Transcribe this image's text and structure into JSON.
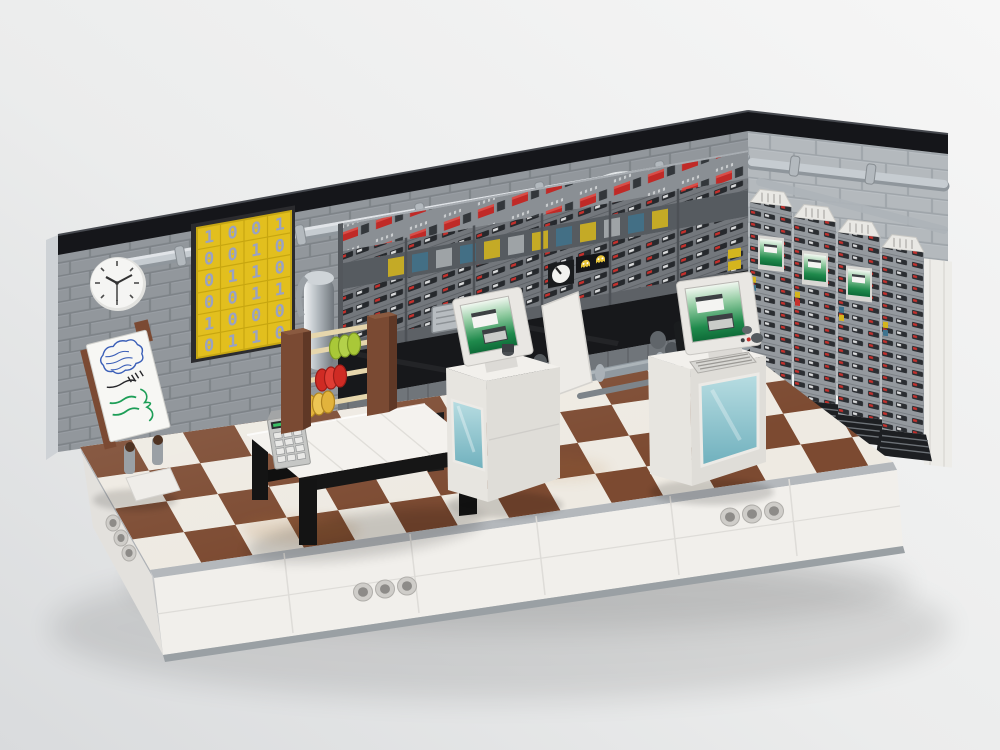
{
  "scene": {
    "description": "3D render of a LEGO retro mainframe computer-room diorama on a pale studio backdrop",
    "background_color": "#ededee"
  },
  "walls": {
    "brick_color": "#9aa0a5",
    "right_brick_color": "#b4b9bd",
    "trim_color": "#141519",
    "pipe_color": "#c6ccd1"
  },
  "poster": {
    "rows": [
      "1001",
      "0010",
      "0110",
      "0011",
      "1000",
      "0110"
    ],
    "tile_color": "#e2bf1e",
    "digit_color": "#9aa2c2",
    "columns": 4,
    "visible_rows": 6
  },
  "clock": {
    "face_color": "#f5f5f3",
    "hour_hand_deg": 300,
    "minute_hand_deg": 60,
    "second_hand_deg": 180
  },
  "whiteboard": {
    "note": "illegible handwritten scribbles",
    "ink_colors": [
      "#3b5fb8",
      "#26262a",
      "#1d9e57"
    ]
  },
  "mainframe": {
    "panel_color": "#7c8186",
    "button_color": "#c02a27",
    "accent_bricks": [
      "#d4b51e",
      "#3f748f"
    ],
    "console_color": "#17181b",
    "gauge_tiles": 2,
    "ghost_tiles": 2
  },
  "cabinets": {
    "count": 4,
    "screen_color": "#1f8a4c"
  },
  "terminals": {
    "count": 2,
    "screen_color": "#1f8a4c",
    "glass_color": "#8fc3cc"
  },
  "abacus": {
    "frame_color": "#7a4a33",
    "rod_color": "#e6d6ac",
    "bead_colors": [
      "#a9c838",
      "#cf2b24",
      "#e2b33c"
    ]
  },
  "calculator": {
    "body_color": "#c6c7c5",
    "display_color": "#2a2d2f"
  },
  "table": {
    "top_color": "#f4f2ee",
    "leg_color": "#141414"
  },
  "floor": {
    "light_tile": "#eeeae2",
    "dark_tile": "#7c4a31"
  },
  "base": {
    "color": "#f1efeb",
    "band_color": "#b4b8bc",
    "holes_per_group": 3,
    "hole_groups": 3
  }
}
